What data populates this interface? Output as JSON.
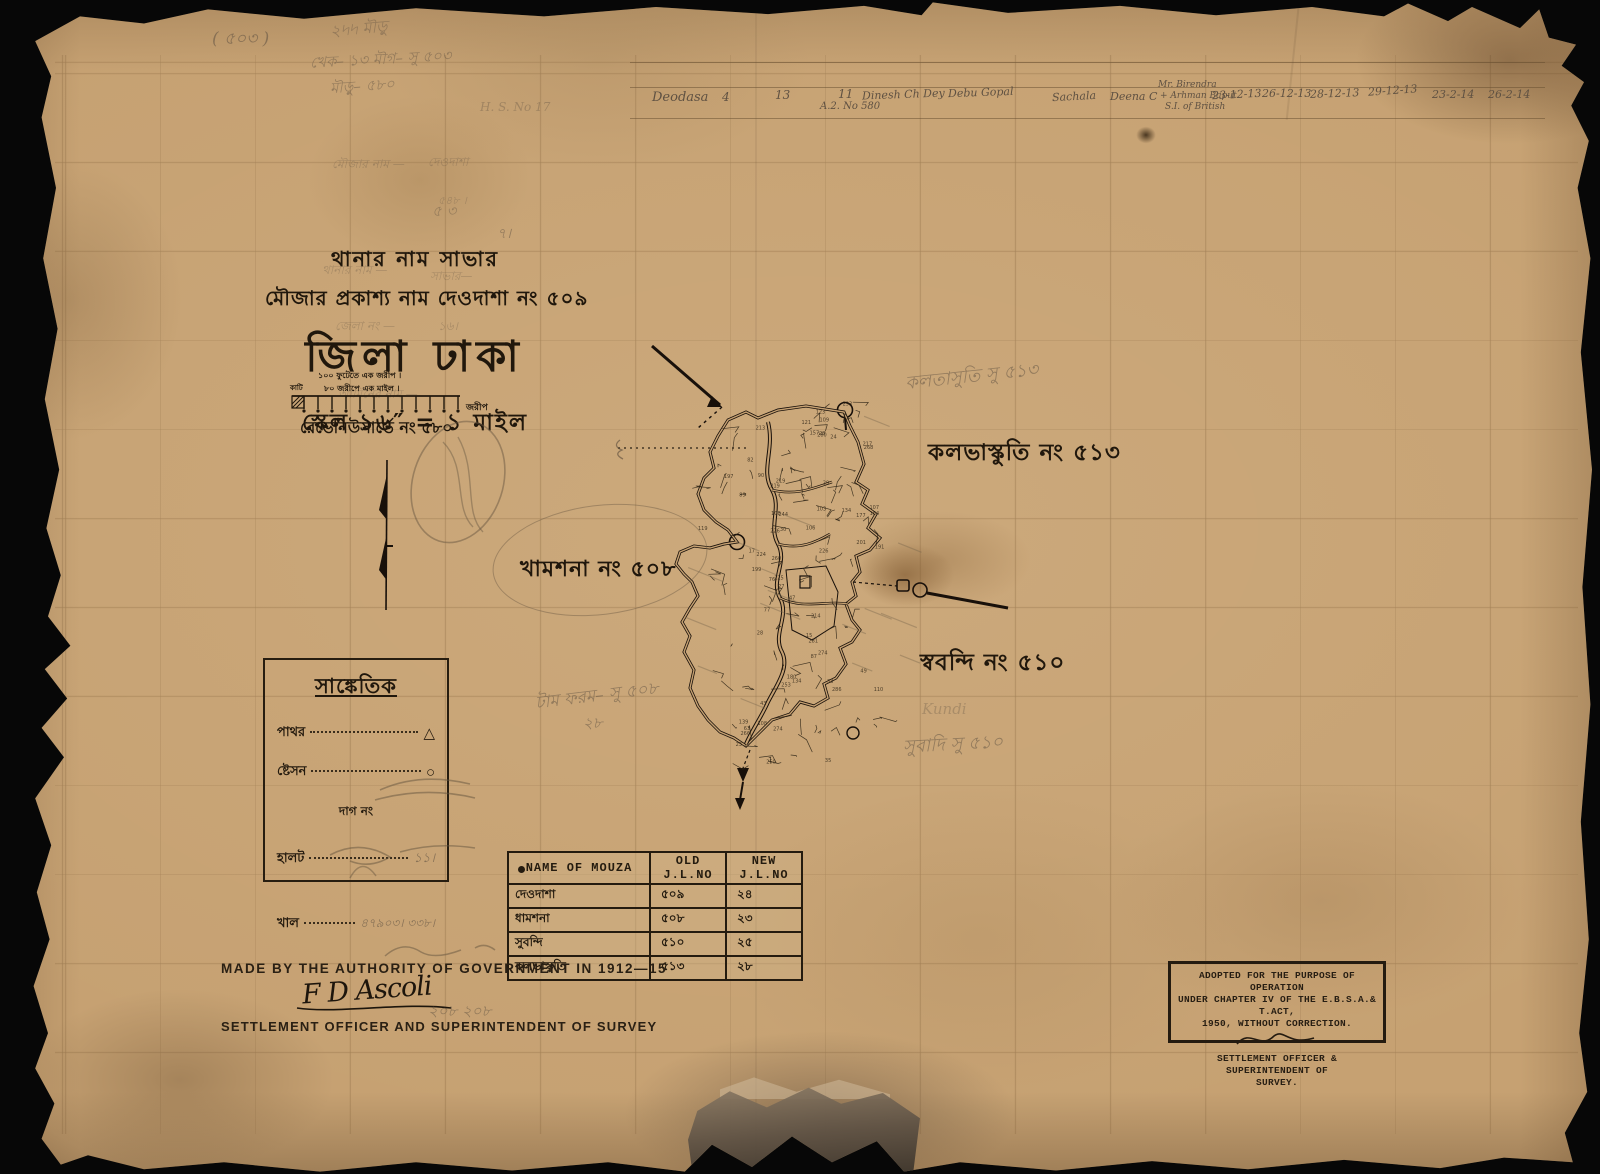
{
  "colors": {
    "paper": "#c6a172",
    "ink": "#20170c",
    "pencil": "#5f5142",
    "grid_line": "#80603a"
  },
  "title_block": {
    "thana_line": "থানার নাম সাভার",
    "mouza_line": "মৌজার প্রকাশ্য নাম দেওদাশা নং ৫০৯",
    "district_line": "জিলা ঢাকা",
    "scale_line": "স্কেল ১৬″ = ১ মাইল",
    "revenue_line": "রেভেনিউসার্ভে নং ৫৮০"
  },
  "scale_bar": {
    "line1": "১০০ ফুটেতে এক জরীপ ।",
    "line2": "৮০ জরীপে এক মাইল ।",
    "left_label": "কাটি",
    "right_label": "জরীপ"
  },
  "map_labels": {
    "kalbhaskuti_ink": "কলভাস্কুতি নং ৫১৩",
    "khamshana_ink": "খামশনা নং ৫০৮",
    "subandi_ink": "স্ববন্দি নং ৫১০",
    "kalbhaskuti_pencil": "কলতাসুতি সু ৫১৩",
    "subandi_pencil": "সুবাদি সু ৫১০",
    "dag_pencil": "টাম ফরম– সু ৫০৮",
    "dag_pencil2": "২৮",
    "kundi_pencil": "Kundi"
  },
  "legend": {
    "title": "সাঙ্কেতিক",
    "row_stone": "পাথর",
    "row_station": "ষ্টেসন",
    "row_mid": "দাগ নং",
    "row_halot": "হালট",
    "row_khal": "খাল",
    "stone_symbol": "△",
    "station_symbol": "○",
    "halot_pencil": "১১।",
    "khal_pencil": "৪৭৯০৩। ৩৩৮।"
  },
  "mouza_table": {
    "headers": [
      "NAME OF MOUZA",
      "OLD J.L.NO",
      "NEW J.L.NO"
    ],
    "rows": [
      [
        "দেওদাশা",
        "৫০৯",
        "২৪"
      ],
      [
        "ধামশনা",
        "৫০৮",
        "২৩"
      ],
      [
        "সুবন্দি",
        "৫১০",
        "২৫"
      ],
      [
        "কলভাস্কুতি",
        "৫১৩",
        "২৮"
      ]
    ]
  },
  "footer": {
    "made_by": "MADE BY THE AUTHORITY OF GOVERNMENT IN 1912—15",
    "signature": "F D Ascoli",
    "officer": "SETTLEMENT OFFICER AND SUPERINTENDENT OF SURVEY",
    "pencil_numbers": "২০৮   ২০৮"
  },
  "stamp": {
    "line1": "ADOPTED FOR THE PURPOSE OF OPERATION",
    "line2": "UNDER CHAPTER IV OF THE E.B.S.A.& T.ACT,",
    "line3": "1950, WITHOUT CORRECTION.",
    "line4": "SETTLEMENT OFFICER & SUPERINTENDENT OF",
    "line5": "SURVEY."
  },
  "pencil_top": {
    "n503": "( ৫০৩ )",
    "scribble1": "২৸৸  মৗড়ু",
    "scribble2": "খেক–  ১৩ মৗগ–  সু ৫০৩",
    "scribble3": "মৗড়ু–  ৫৮০",
    "hs_no": "H. S. No 17",
    "mark1": "৫ ৩",
    "mark2": "৭।"
  },
  "pencil_left_col": {
    "r1l": "মৌজার নাম —",
    "r1r": "দেওদাশা",
    "r2r": "৫৪৮ ।",
    "r3l": "থানার নাম —",
    "r3r": "সাভার—",
    "r4l": "জেলা নং —",
    "r4r": "১৬।",
    "r5l": "আমিনের নাম —"
  },
  "survey_row": {
    "name": "Deodasa",
    "c1": "4",
    "c2": "13",
    "c3": "11",
    "c3b": "A.2. No 580",
    "c4": "Dinesh Ch Dey",
    "c5": "Debu Gopal",
    "c6": "Sachala",
    "c7": "Deena C",
    "c8a": "Mr. Birendra",
    "c8b": "+ Arhman Baput",
    "c8c": "S.I. of British",
    "d1": "23-12-13",
    "d2": "26-12-13",
    "d3": "28-12-13",
    "d4": "29-12-13",
    "d5": "23-2-14",
    "d6": "26-2-14"
  }
}
